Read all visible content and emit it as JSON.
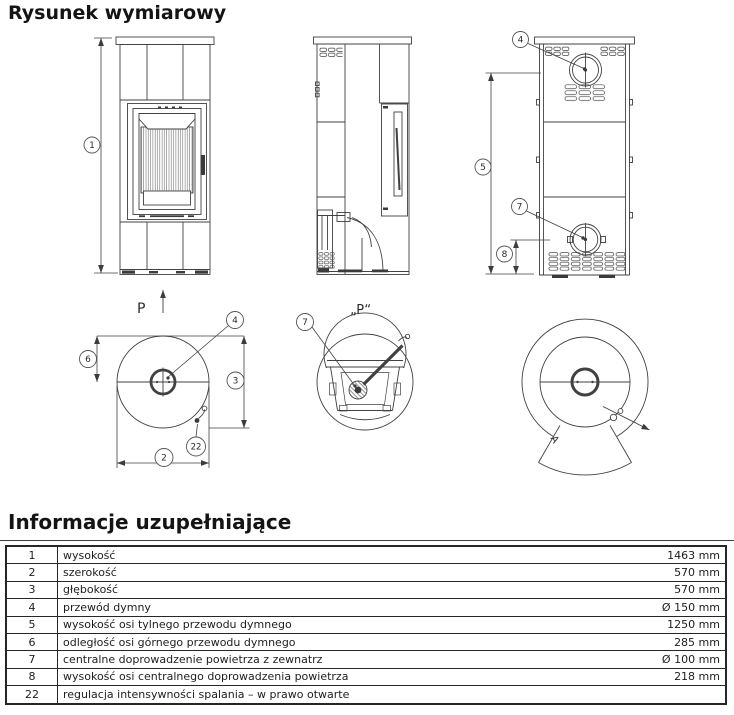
{
  "title": "Rysunek wymiarowy",
  "drawing": {
    "labels": {
      "front_marker": "P",
      "section_marker": "„P“",
      "rotation_angle": "A"
    },
    "callouts": {
      "c1": "1",
      "c2": "2",
      "c3": "3",
      "c4": "4",
      "c5": "5",
      "c6": "6",
      "c7": "7",
      "c8": "8",
      "c22": "22"
    }
  },
  "info": {
    "heading": "Informacje uzupełniające",
    "rows": [
      {
        "no": "1",
        "label": "wysokość",
        "value": "1463 mm"
      },
      {
        "no": "2",
        "label": "szerokość",
        "value": "570 mm"
      },
      {
        "no": "3",
        "label": "głębokość",
        "value": "570 mm"
      },
      {
        "no": "4",
        "label": "przewód dymny",
        "value": "Ø 150 mm"
      },
      {
        "no": "5",
        "label": "wysokość osi tylnego przewodu dymnego",
        "value": "1250 mm"
      },
      {
        "no": "6",
        "label": "odległość osi górnego przewodu dymnego",
        "value": "285 mm"
      },
      {
        "no": "7",
        "label": "centralne doprowadzenie powietrza z zewnatrz",
        "value": "Ø 100 mm"
      },
      {
        "no": "8",
        "label": "wysokość osi centralnego doprowadzenia powietrza",
        "value": "218 mm"
      },
      {
        "no": "22",
        "label": "regulacja intensywności spalania – w prawo otwarte",
        "value": ""
      }
    ]
  }
}
